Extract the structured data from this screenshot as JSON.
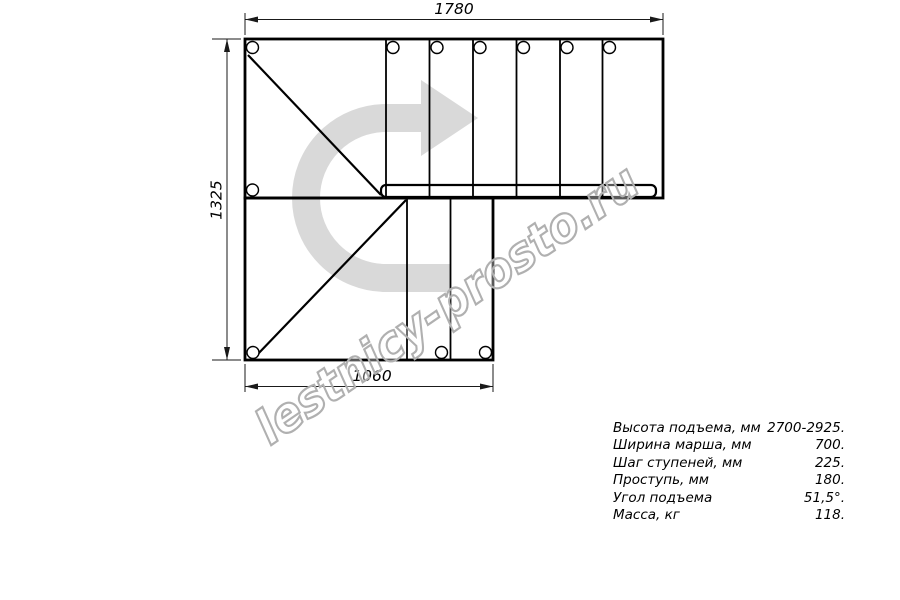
{
  "drawing": {
    "title": "stair-plan-180-turn",
    "watermark_text": "lestnicy-prosto.ru",
    "dimensions": {
      "top": "1780",
      "left": "1325",
      "bottom": "1060"
    },
    "colors": {
      "line": "#000000",
      "dimension_line": "#1a1a1a",
      "arrow_fill": "#d9d9d9",
      "watermark_outline": "#b0b0b0",
      "background": "#ffffff"
    }
  },
  "specs": {
    "rows": [
      {
        "label": "Высота подъема, мм",
        "value": "2700-2925."
      },
      {
        "label": "Ширина марша, мм",
        "value": "700."
      },
      {
        "label": "Шаг ступеней, мм",
        "value": "225."
      },
      {
        "label": "Проступь, мм",
        "value": "180."
      },
      {
        "label": "Угол подъема",
        "value": "51,5°."
      },
      {
        "label": "Масса, кг",
        "value": "118."
      }
    ]
  }
}
